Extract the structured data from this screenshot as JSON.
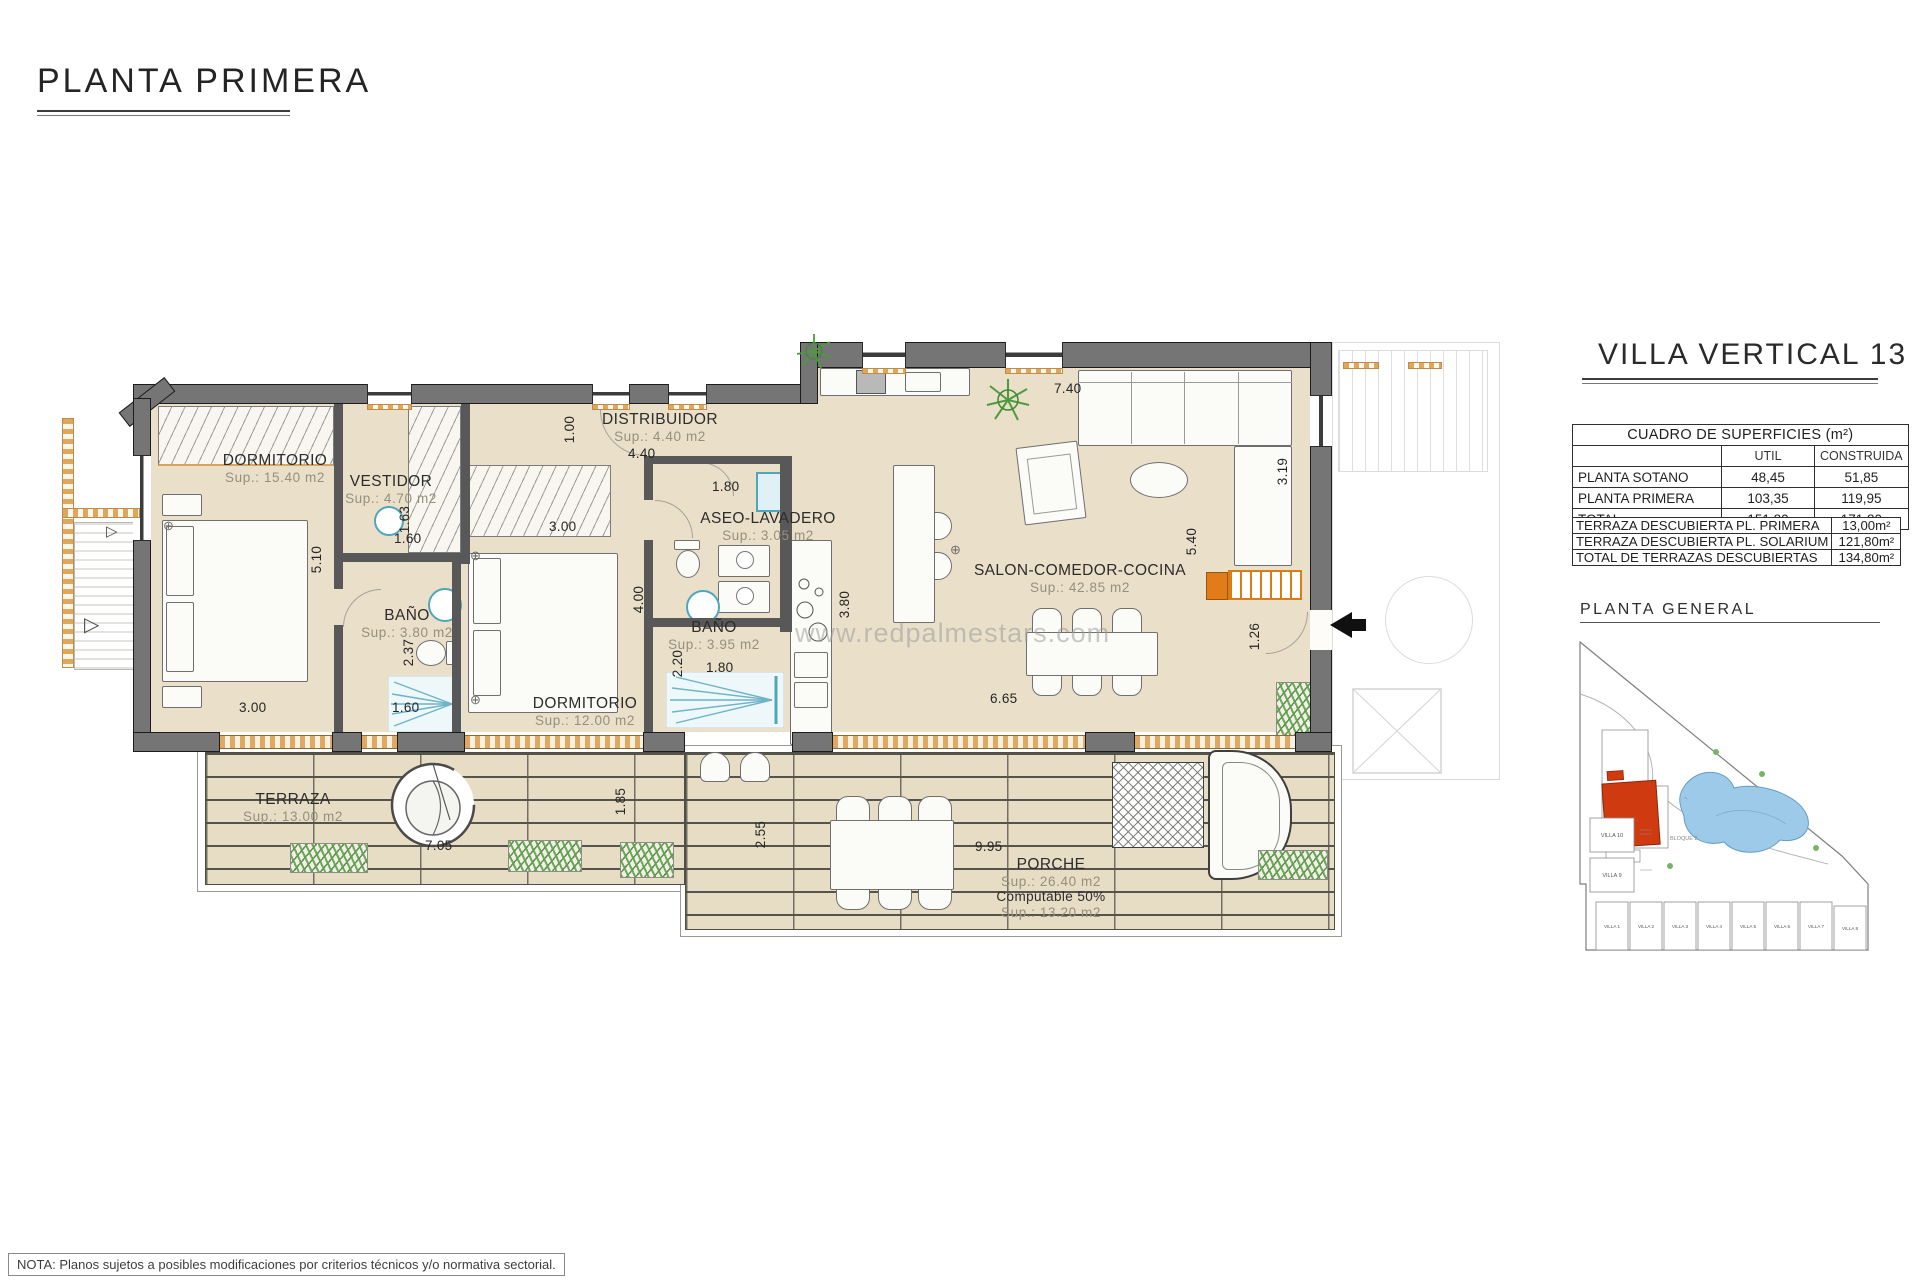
{
  "page": {
    "title": "PLANTA PRIMERA",
    "watermark": "www.redpalmestars.com",
    "note": "NOTA: Planos sujetos a posibles modificaciones por criterios técnicos y/o normativa sectorial."
  },
  "rooms": [
    {
      "name": "DORMITORIO",
      "sup": "Sup.: 15.40  m2"
    },
    {
      "name": "VESTIDOR",
      "sup": "Sup.: 4.70  m2"
    },
    {
      "name": "DISTRIBUIDOR",
      "sup": "Sup.: 4.40  m2"
    },
    {
      "name": "ASEO-LAVADERO",
      "sup": "Sup.: 3.05  m2"
    },
    {
      "name": "BAÑO",
      "sup": "Sup.: 3.80  m2"
    },
    {
      "name": "BAÑO",
      "sup": "Sup.: 3.95  m2"
    },
    {
      "name": "DORMITORIO",
      "sup": "Sup.: 12.00  m2"
    },
    {
      "name": "SALON-COMEDOR-COCINA",
      "sup": "Sup.: 42.85  m2"
    },
    {
      "name": "TERRAZA",
      "sup": "Sup.: 13.00  m2"
    },
    {
      "name": "PORCHE",
      "sup": "Sup.: 26.40  m2",
      "note": "Computable 50%",
      "sup2": "Sup.: 13.20  m2"
    }
  ],
  "dims": [
    "1.00",
    "4.40",
    "1.80",
    "1.63",
    "1.60",
    "3.00",
    "5.10",
    "2.37",
    "1.60",
    "3.00",
    "4.00",
    "2.20",
    "1.80",
    "3.80",
    "7.40",
    "3.19",
    "5.40",
    "1.26",
    "6.65",
    "7.05",
    "1.85",
    "2.55",
    "9.95"
  ],
  "panel": {
    "title": "VILLA VERTICAL 13",
    "table": {
      "caption": "CUADRO DE SUPERFICIES (m²)",
      "col_util": "UTIL",
      "col_construida": "CONSTRUIDA",
      "rows": [
        {
          "label": "PLANTA SOTANO",
          "util": "48,45",
          "construida": "51,85"
        },
        {
          "label": "PLANTA PRIMERA",
          "util": "103,35",
          "construida": "119,95"
        },
        {
          "label": "TOTAL",
          "util": "151,80",
          "construida": "171,80"
        }
      ]
    },
    "terraces": [
      {
        "label": "TERRAZA DESCUBIERTA PL. PRIMERA",
        "value": "13,00m²"
      },
      {
        "label": "TERRAZA DESCUBIERTA PL. SOLARIUM",
        "value": "121,80m²"
      },
      {
        "label": "TOTAL DE TERRAZAS DESCUBIERTAS",
        "value": "134,80m²"
      }
    ],
    "siteplan_title": "PLANTA GENERAL",
    "siteplan_block": "BLOQUE 2",
    "siteplan_villas": [
      "VILLA 10",
      "VILLA 9",
      "VILLA 1",
      "VILLA 2",
      "VILLA 3",
      "VILLA 4",
      "VILLA 5",
      "VILLA 6",
      "VILLA 7",
      "VILLA 8"
    ]
  },
  "colors": {
    "floor": "#eadfc9",
    "wall": "#757575",
    "accent_orange": "#d97d17",
    "fixture_blue": "#4fa6bd",
    "site_red": "#d03a10",
    "pool_blue": "#9ccae8"
  }
}
